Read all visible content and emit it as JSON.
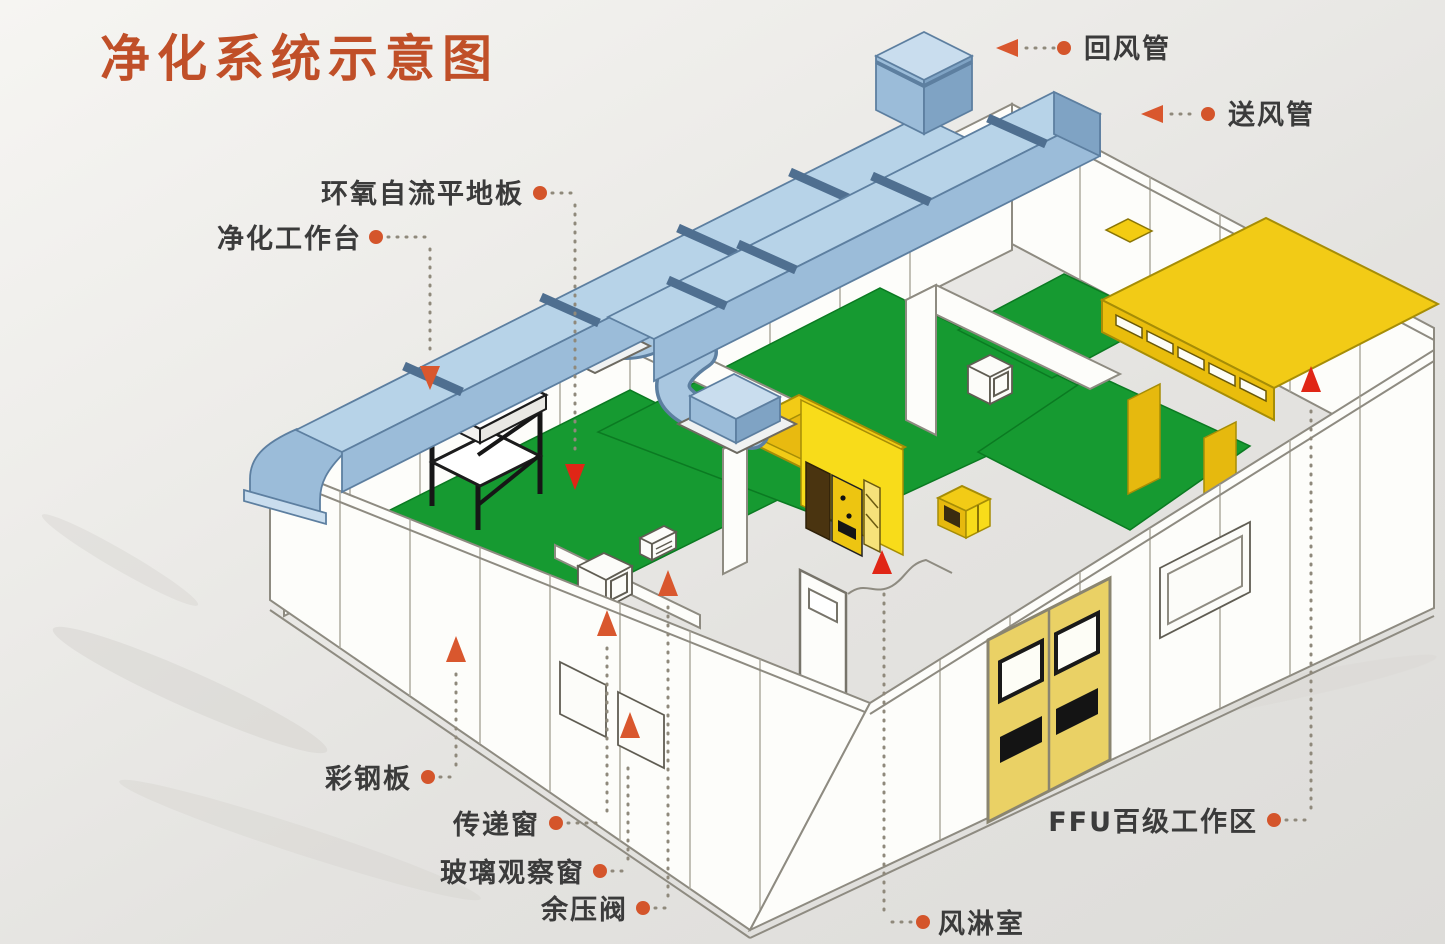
{
  "meta": {
    "width": 1445,
    "height": 944,
    "type": "isometric-schematic"
  },
  "title": {
    "text": "净化系统示意图"
  },
  "labels": {
    "return_duct": "回风管",
    "supply_duct": "送风管",
    "epoxy_floor": "环氧自流平地板",
    "clean_workbench": "净化工作台",
    "color_steel_panel": "彩钢板",
    "transfer_window": "传递窗",
    "glass_observation_window": "玻璃观察窗",
    "residual_pressure_valve": "余压阀",
    "air_shower_room": "风淋室",
    "ffu_work_area": "FFU百级工作区"
  },
  "icons": {
    "leader_dot": "filled-circle",
    "leader_arrow_left": "triangle-left",
    "pointer_up": "triangle-up",
    "pointer_down": "triangle-down"
  },
  "colors": {
    "title_text": "#c04f28",
    "label_text": "#3b3b3b",
    "leader_dot": "#d4552b",
    "leader_line": "#8f897b",
    "pointer_orange": "#d9572e",
    "pointer_red": "#e02616",
    "duct_blue": "#a9c7e0",
    "floor_green": "#169a31",
    "equipment_yellow": "#f2cb16",
    "wall_white": "#fdfdfa",
    "background": "#e8e7e4"
  }
}
